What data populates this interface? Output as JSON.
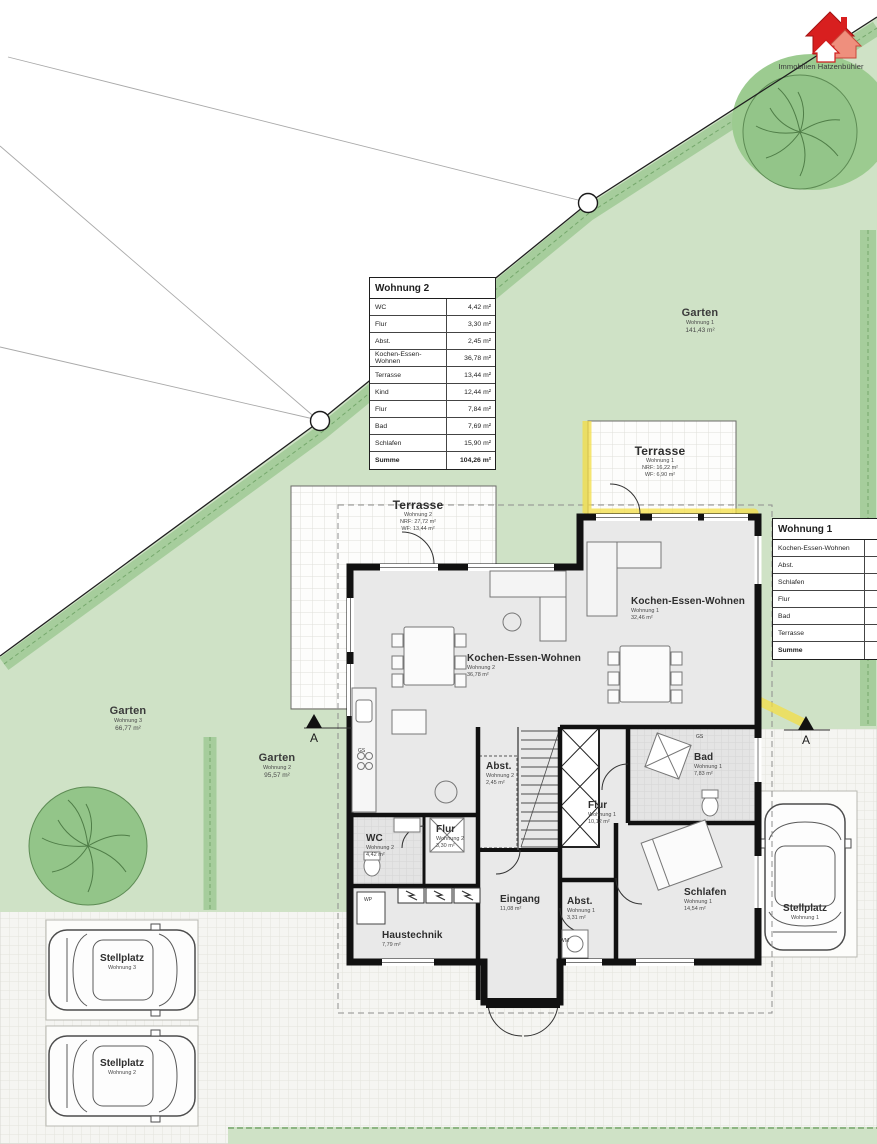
{
  "logo": {
    "company": "Immobilien Hatzenbühler"
  },
  "markers": {
    "section": "A"
  },
  "small_labels": {
    "gs": "GS",
    "wp": "WP",
    "wm": "WM"
  },
  "gardens": [
    {
      "name": "Garten",
      "unit": "Wohnung 1",
      "area": "141,43 m²"
    },
    {
      "name": "Garten",
      "unit": "Wohnung 3",
      "area": "66,77 m²"
    },
    {
      "name": "Garten",
      "unit": "Wohnung 2",
      "area": "95,57 m²"
    }
  ],
  "terraces": [
    {
      "name": "Terrasse",
      "unit": "Wohnung 1",
      "nrf": "NRF: 16,22 m²",
      "wf": "WF: 6,90 m²"
    },
    {
      "name": "Terrasse",
      "unit": "Wohnung 2",
      "nrf": "NRF: 27,72 m²",
      "wf": "WF: 13,44 m²"
    }
  ],
  "rooms": [
    {
      "name": "Kochen-Essen-Wohnen",
      "unit": "Wohnung 2",
      "area": "36,78 m²"
    },
    {
      "name": "Kochen-Essen-Wohnen",
      "unit": "Wohnung 1",
      "area": "32,46 m²"
    },
    {
      "name": "Abst.",
      "unit": "Wohnung 2",
      "area": "2,45 m²"
    },
    {
      "name": "WC",
      "unit": "Wohnung 2",
      "area": "4,42 m²"
    },
    {
      "name": "Flur",
      "unit": "Wohnung 2",
      "area": "3,30 m²"
    },
    {
      "name": "Bad",
      "unit": "Wohnung 1",
      "area": "7,83 m²"
    },
    {
      "name": "Flur",
      "unit": "Wohnung 1",
      "area": "10,12 m²"
    },
    {
      "name": "Schlafen",
      "unit": "Wohnung 1",
      "area": "14,54 m²"
    },
    {
      "name": "Abst.",
      "unit": "Wohnung 1",
      "area": "3,31 m²"
    },
    {
      "name": "Eingang",
      "area": "11,08 m²"
    },
    {
      "name": "Haustechnik",
      "area": "7,79 m²"
    }
  ],
  "parking": [
    {
      "name": "Stellplatz",
      "unit": "Wohnung 3"
    },
    {
      "name": "Stellplatz",
      "unit": "Wohnung 2"
    },
    {
      "name": "Stellplatz",
      "unit": "Wohnung 1"
    }
  ],
  "tables": {
    "wohnung2": {
      "title": "Wohnung 2",
      "rows": [
        {
          "label": "WC",
          "value": "4,42 m²"
        },
        {
          "label": "Flur",
          "value": "3,30 m²"
        },
        {
          "label": "Abst.",
          "value": "2,45 m²"
        },
        {
          "label": "Kochen-Essen-Wohnen",
          "value": "36,78 m²"
        },
        {
          "label": "Terrasse",
          "value": "13,44 m²"
        },
        {
          "label": "Kind",
          "value": "12,44 m²"
        },
        {
          "label": "Flur",
          "value": "7,84 m²"
        },
        {
          "label": "Bad",
          "value": "7,69 m²"
        },
        {
          "label": "Schlafen",
          "value": "15,90 m²"
        },
        {
          "label": "Summe",
          "value": "104,26 m²"
        }
      ]
    },
    "wohnung1": {
      "title": "Wohnung 1",
      "rows": [
        {
          "label": "Kochen-Essen-Wohnen",
          "value": ""
        },
        {
          "label": "Abst.",
          "value": ""
        },
        {
          "label": "Schlafen",
          "value": ""
        },
        {
          "label": "Flur",
          "value": ""
        },
        {
          "label": "Bad",
          "value": ""
        },
        {
          "label": "Terrasse",
          "value": ""
        },
        {
          "label": "Summe",
          "value": ""
        }
      ]
    }
  },
  "colors": {
    "garden_green": "#cfe2c6",
    "hedge_green": "#a6cd9c",
    "highlight_yellow": "#f3dd45",
    "wall_black": "#111111",
    "logo_red": "#d81f1f"
  }
}
